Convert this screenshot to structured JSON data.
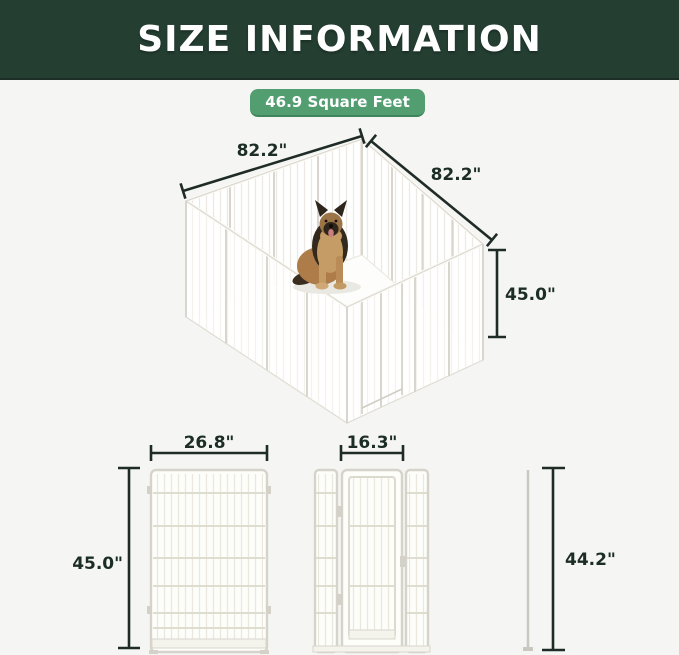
{
  "header": {
    "title": "SIZE INFORMATION"
  },
  "badge": {
    "label": "46.9 Square Feet"
  },
  "colors": {
    "header_bg": "#243E32",
    "badge_bg": "#529E70",
    "dimension_line": "#1f2b26",
    "dimension_text": "#1C2D25",
    "panel_outline": "#d6d4ca",
    "panel_bar": "#e9e7de",
    "background": "#f5f6f4"
  },
  "isometric_view": {
    "width_label": "82.2\"",
    "depth_label": "82.2\"",
    "height_label": "45.0\"",
    "dog": "german-shepherd"
  },
  "panel_views": {
    "full_panel": {
      "width_label": "26.8\"",
      "height_label": "45.0\""
    },
    "door_panel": {
      "width_label": "16.3\""
    },
    "side_profile": {
      "height_label": "44.2\""
    }
  }
}
